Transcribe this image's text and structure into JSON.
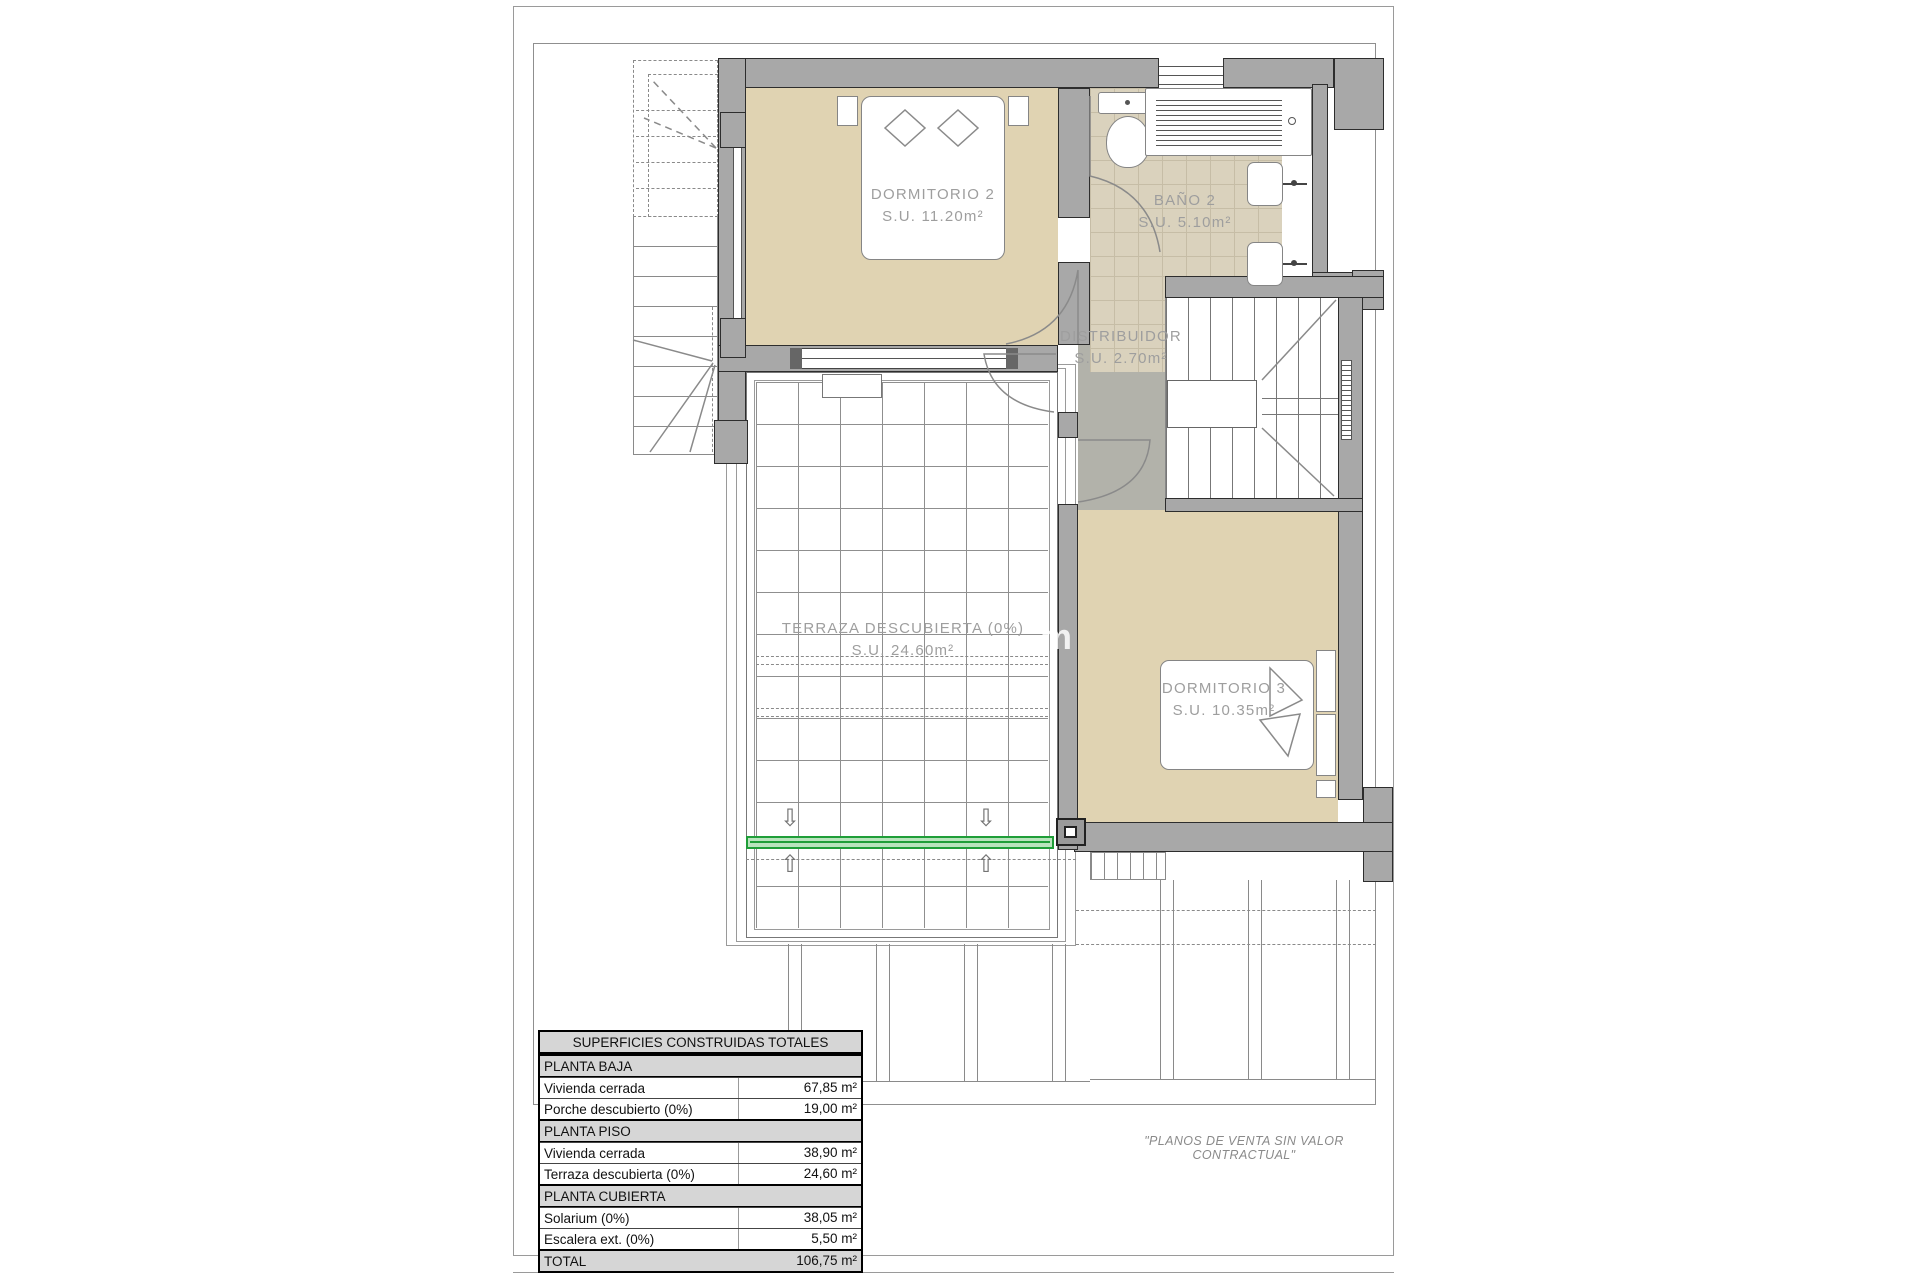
{
  "page": {
    "disclaimer": "\"PLANOS DE VENTA SIN VALOR CONTRACTUAL\"",
    "watermark_fragment": "m"
  },
  "rooms": [
    {
      "name": "DORMITORIO 2",
      "area": "S.U. 11.20m²"
    },
    {
      "name": "BAÑO 2",
      "area": "S.U. 5.10m²"
    },
    {
      "name": "DISTRIBUIDOR",
      "area": "S.U. 2.70m²"
    },
    {
      "name": "DORMITORIO 3",
      "area": "S.U. 10.35m²"
    },
    {
      "name": "TERRAZA DESCUBIERTA (0%)",
      "area": "S.U. 24.60m²"
    }
  ],
  "arrows": {
    "down": "⇩",
    "up": "⇧"
  },
  "table": {
    "title": "SUPERFICIES CONSTRUIDAS TOTALES",
    "sections": [
      {
        "header": "PLANTA BAJA",
        "rows": [
          [
            "Vivienda cerrada",
            "67,85 m²"
          ],
          [
            "Porche descubierto (0%)",
            "19,00 m²"
          ]
        ]
      },
      {
        "header": "PLANTA PISO",
        "rows": [
          [
            "Vivienda cerrada",
            "38,90 m²"
          ],
          [
            "Terraza descubierta (0%)",
            "24,60 m²"
          ]
        ]
      },
      {
        "header": "PLANTA CUBIERTA",
        "rows": [
          [
            "Solarium (0%)",
            "38,05 m²"
          ],
          [
            "Escalera ext. (0%)",
            "5,50 m²"
          ]
        ]
      }
    ],
    "total": {
      "label": "TOTAL",
      "value": "106,75 m²"
    }
  },
  "colors": {
    "wall": "#a8a8a8",
    "room_tan": "#e0d3b2",
    "bath_tile": "#dad2bd",
    "hall_gray": "#b2b2aa",
    "accent_green": "#1f9e38",
    "label_gray": "#9e9e9e"
  }
}
